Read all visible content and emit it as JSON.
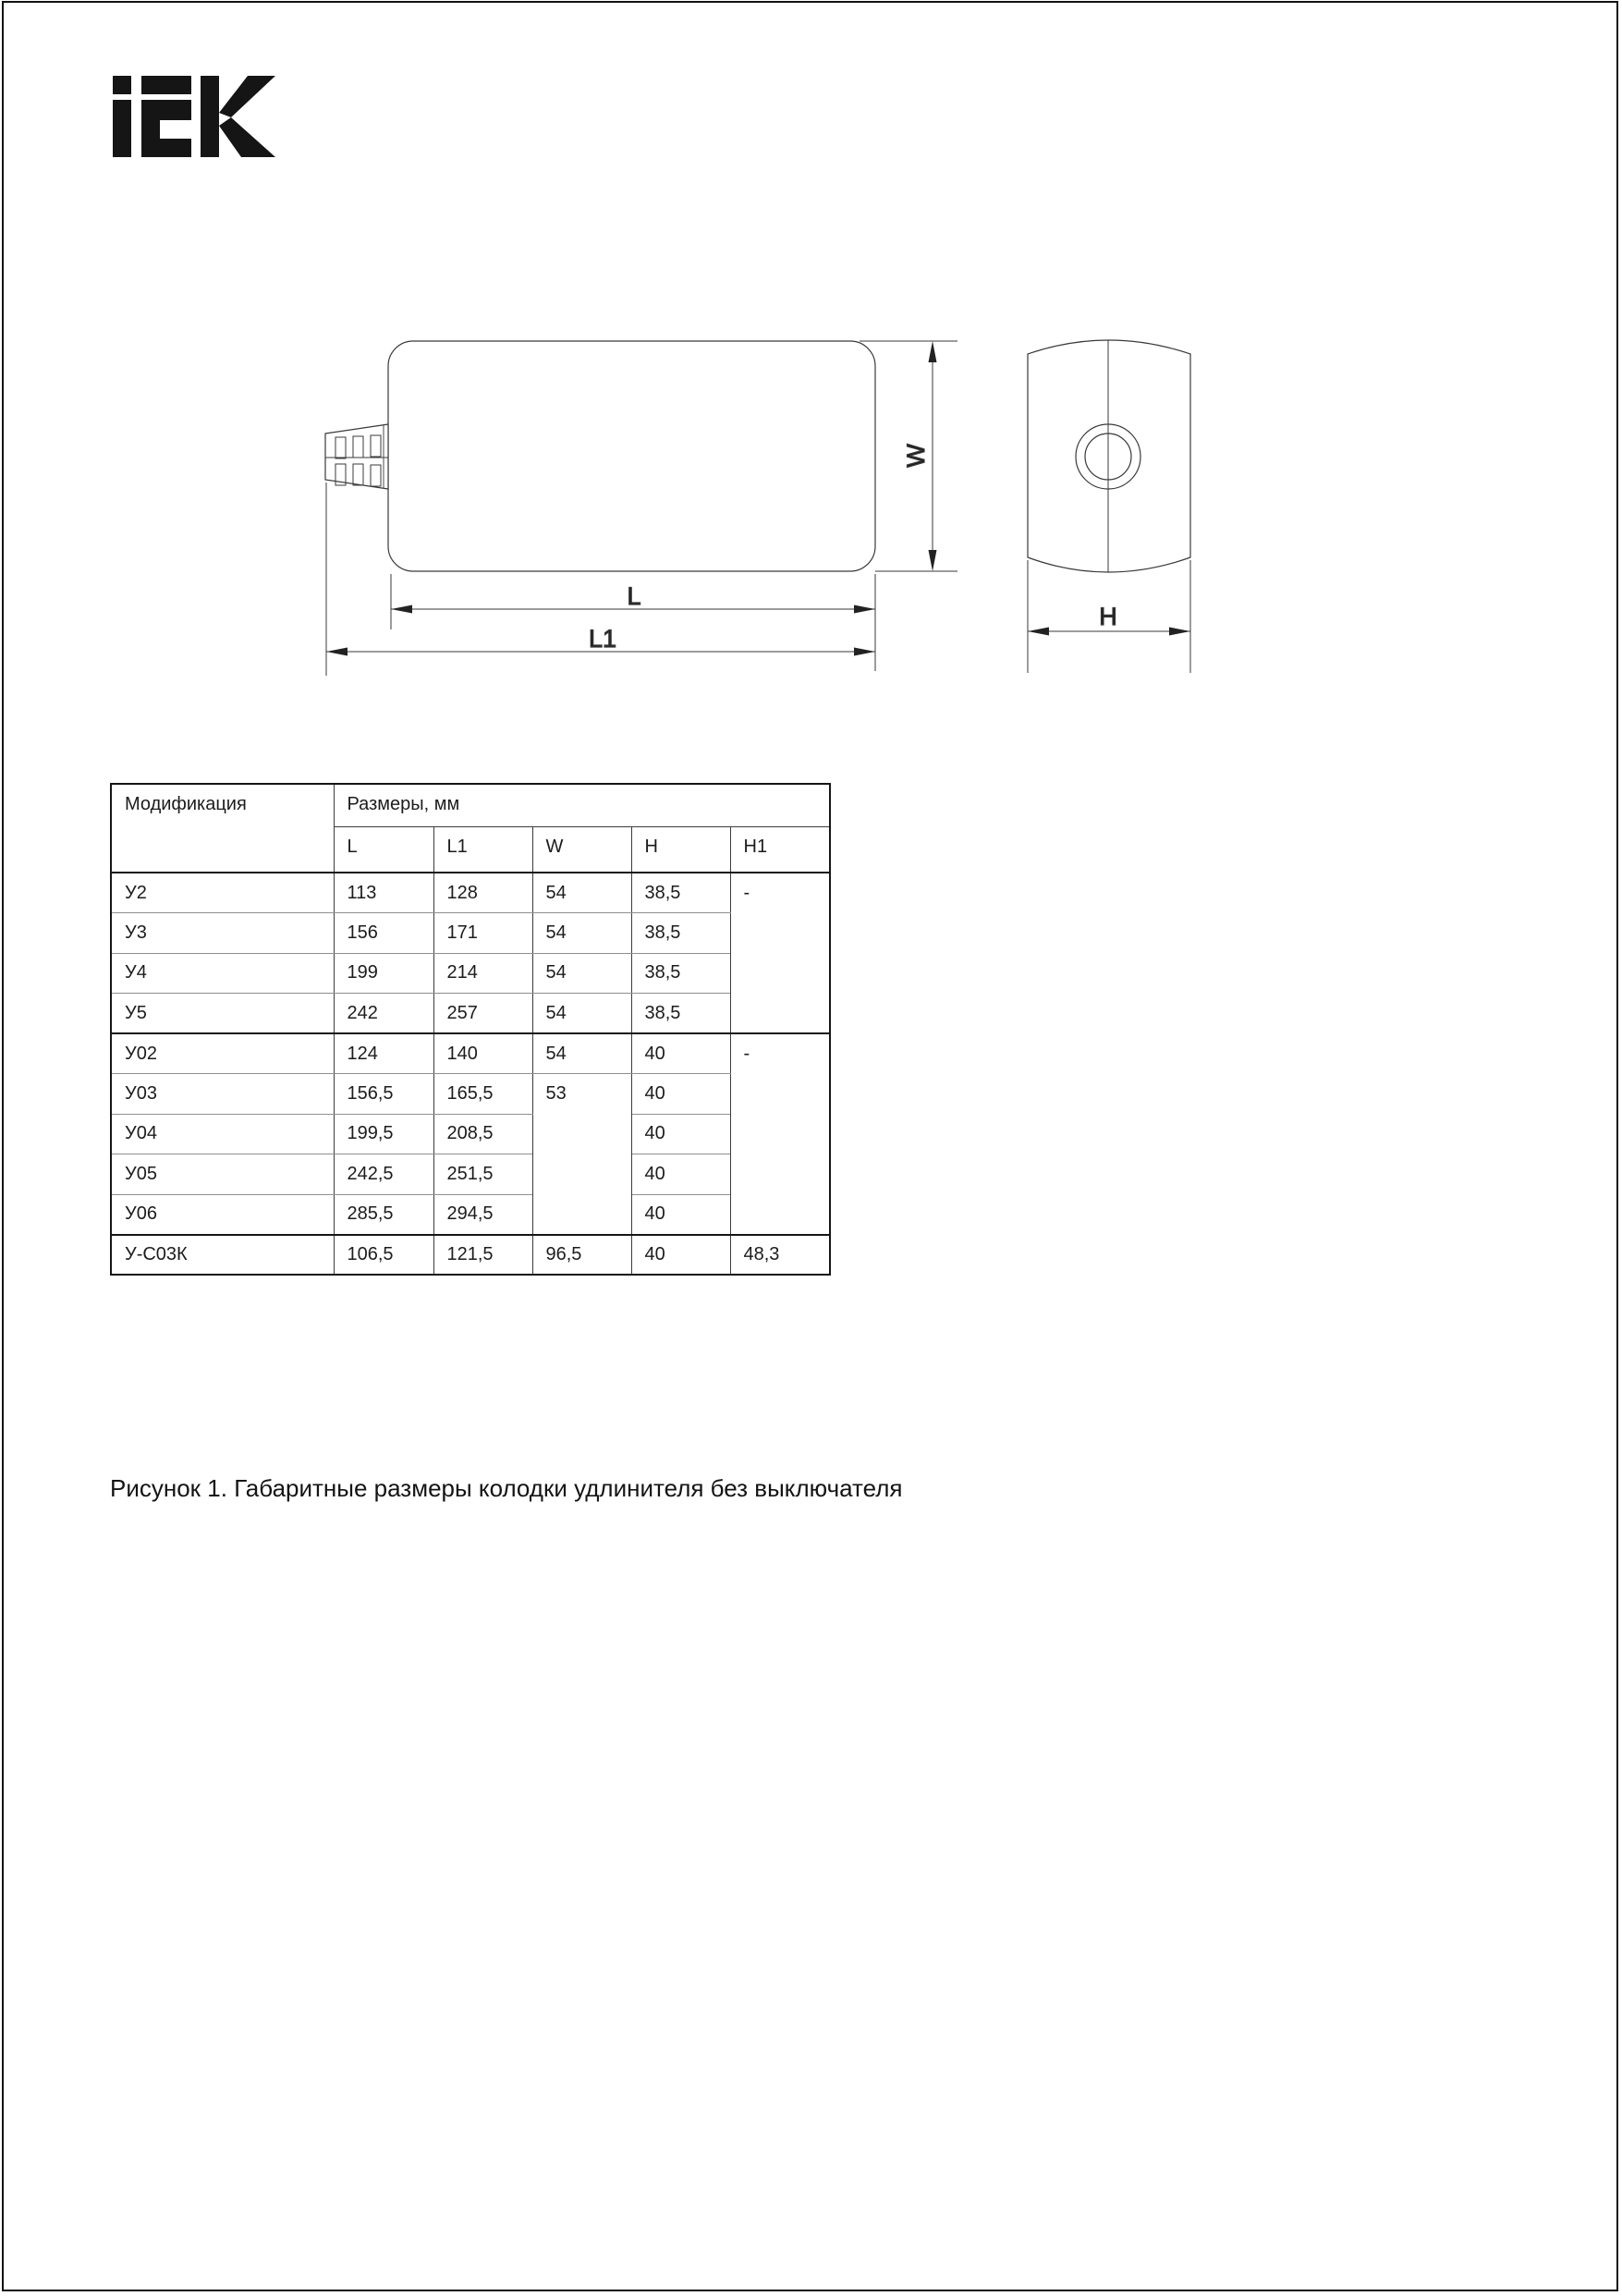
{
  "logo": {
    "brand": "IEK"
  },
  "drawing": {
    "labels": {
      "w": "W",
      "l": "L",
      "l1": "L1",
      "h": "H"
    }
  },
  "table": {
    "col_modification": "Модификация",
    "col_dimensions_group": "Размеры, мм",
    "columns": {
      "l": "L",
      "l1": "L1",
      "w": "W",
      "h": "H",
      "h1": "H1"
    },
    "rows": [
      {
        "mod": "У2",
        "l": "113",
        "l1": "128",
        "w": "54",
        "h": "38,5",
        "h1": "-"
      },
      {
        "mod": "У3",
        "l": "156",
        "l1": "171",
        "w": "54",
        "h": "38,5"
      },
      {
        "mod": "У4",
        "l": "199",
        "l1": "214",
        "w": "54",
        "h": "38,5"
      },
      {
        "mod": "У5",
        "l": "242",
        "l1": "257",
        "w": "54",
        "h": "38,5"
      },
      {
        "mod": "У02",
        "l": "124",
        "l1": "140",
        "w": "54",
        "h": "40",
        "h1": "-"
      },
      {
        "mod": "У03",
        "l": "156,5",
        "l1": "165,5",
        "w": "53",
        "h": "40"
      },
      {
        "mod": "У04",
        "l": "199,5",
        "l1": "208,5",
        "h": "40"
      },
      {
        "mod": "У05",
        "l": "242,5",
        "l1": "251,5",
        "h": "40"
      },
      {
        "mod": "У06",
        "l": "285,5",
        "l1": "294,5",
        "h": "40"
      },
      {
        "mod": "У-С03К",
        "l": "106,5",
        "l1": "121,5",
        "w": "96,5",
        "h": "40",
        "h1": "48,3"
      }
    ]
  },
  "caption": "Рисунок 1. Габаритные размеры колодки удлинителя без выключателя"
}
